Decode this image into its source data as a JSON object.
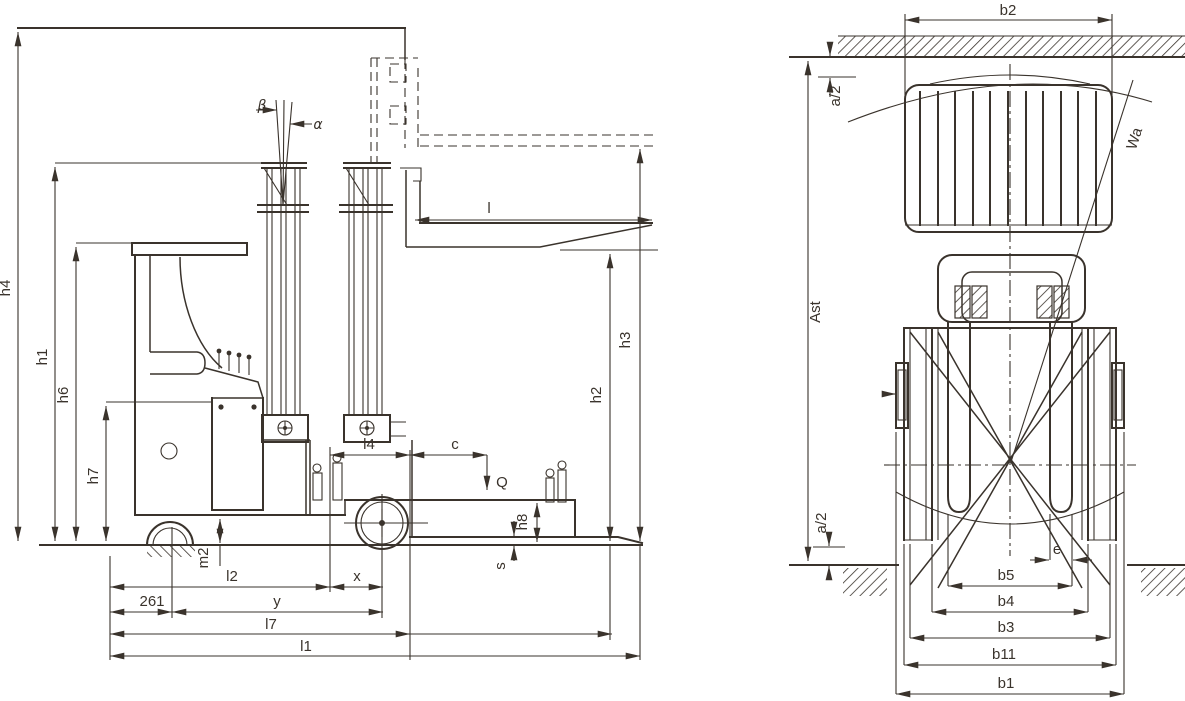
{
  "drawing": {
    "line_color": "#3a332c",
    "background": "#ffffff",
    "side_view": {
      "heights": {
        "h1": "h1",
        "h2": "h2",
        "h3": "h3",
        "h4": "h4",
        "h6": "h6",
        "h7": "h7",
        "h8": "h8",
        "m2": "m2"
      },
      "lengths": {
        "l": "l",
        "l1": "l1",
        "l2": "l2",
        "l4": "l4",
        "l7": "l7",
        "x": "x",
        "y": "y",
        "overhang_261": "261",
        "s": "s",
        "c": "c",
        "q": "Q"
      },
      "angles": {
        "alpha": "α",
        "beta": "β"
      }
    },
    "top_view": {
      "widths": {
        "b1": "b1",
        "b2": "b2",
        "b3": "b3",
        "b4": "b4",
        "b5": "b5",
        "b11": "b11",
        "e": "e"
      },
      "aisle": {
        "ast": "Ast",
        "a2_top": "a/2",
        "a2_bottom": "a/2",
        "wa": "Wa"
      }
    }
  }
}
